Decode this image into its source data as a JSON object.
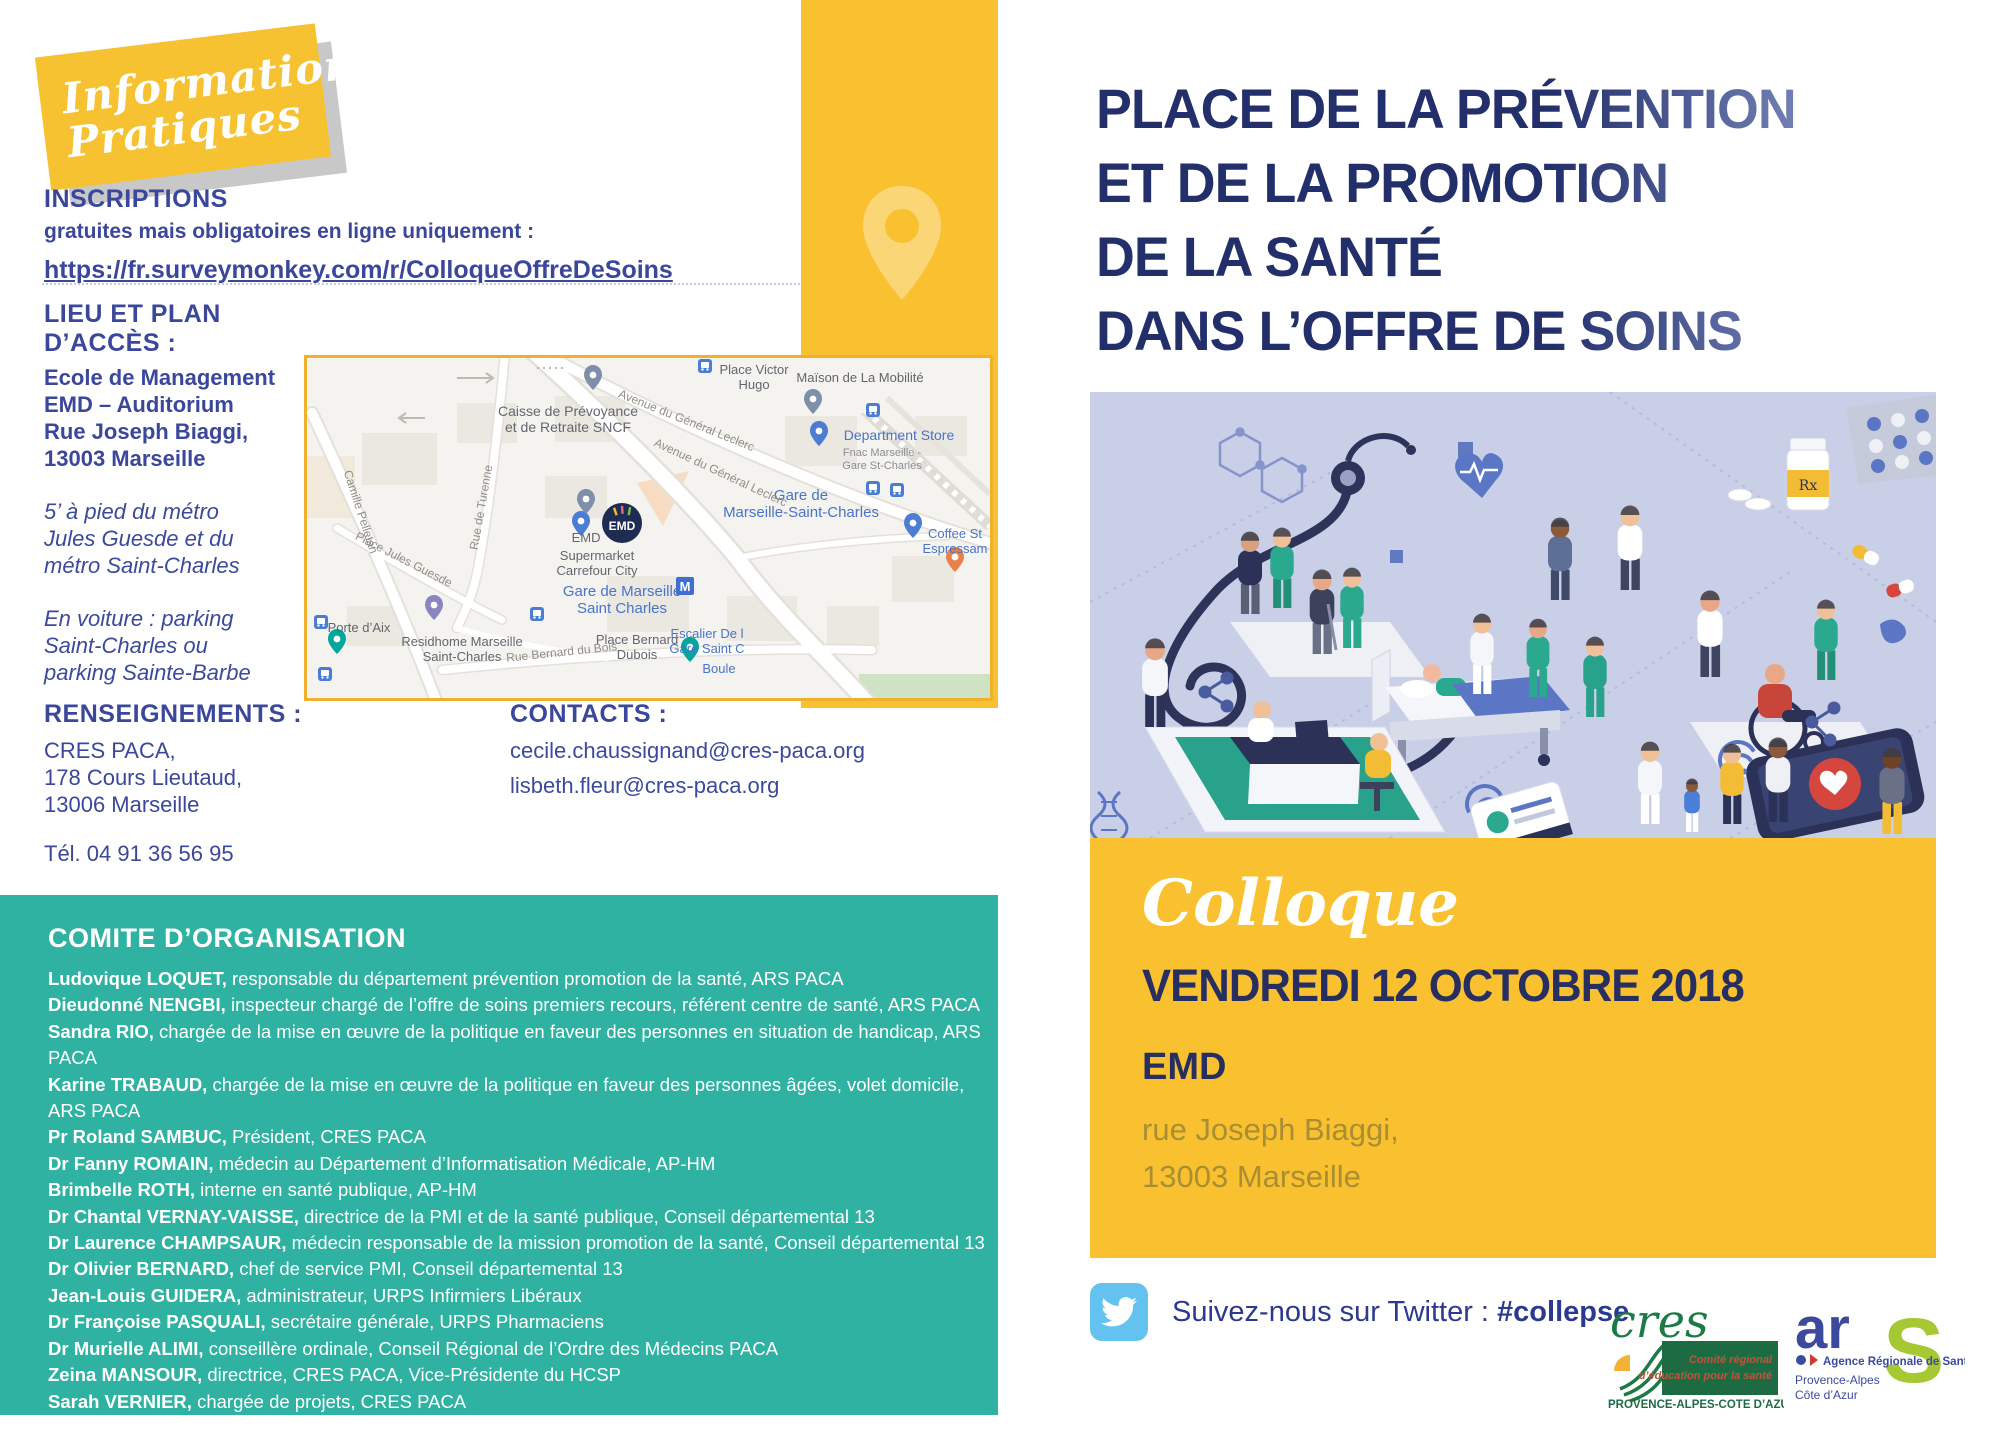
{
  "badge": {
    "line1": "Informations",
    "line2": "Pratiques"
  },
  "inscriptions": {
    "title": "INSCRIPTIONS",
    "subtitle": "gratuites mais obligatoires en ligne uniquement :",
    "link": "https://fr.surveymonkey.com/r/ColloqueOffreDeSoins"
  },
  "lieu": {
    "title": "LIEU ET PLAN D’ACCÈS :",
    "address_lines": [
      "Ecole de Management EMD – Auditorium",
      "Rue Joseph Biaggi,",
      "13003 Marseille"
    ],
    "metro": "5’ à pied du métro Jules Guesde et du métro Saint-Charles",
    "voiture": "En voiture : parking Saint-Charles ou parking Sainte-Barbe"
  },
  "renseignements": {
    "title": "RENSEIGNEMENTS :",
    "lines": [
      "CRES PACA,",
      "178 Cours Lieutaud,",
      "13006 Marseille"
    ],
    "tel": "Tél. 04 91 36 56 95",
    "site": "www.cres-paca.org"
  },
  "contacts": {
    "title": "CONTACTS :",
    "emails": [
      "cecile.chaussignand@cres-paca.org",
      "lisbeth.fleur@cres-paca.org"
    ]
  },
  "comite": {
    "title": "COMITE D’ORGANISATION",
    "members": [
      {
        "name": "Ludovique LOQUET",
        "role": "responsable du département prévention promotion de la santé, ARS PACA"
      },
      {
        "name": "Dieudonné NENGBI",
        "role": "inspecteur chargé de l’offre de soins premiers recours, référent centre de santé, ARS PACA"
      },
      {
        "name": "Sandra RIO",
        "role": "chargée de la mise en œuvre de la politique en faveur des personnes en situation de handicap, ARS PACA"
      },
      {
        "name": "Karine TRABAUD",
        "role": "chargée de la mise en œuvre de la politique en faveur des personnes âgées, volet domicile, ARS PACA"
      },
      {
        "name": "Pr Roland SAMBUC",
        "role": "Président, CRES PACA"
      },
      {
        "name": "Dr Fanny ROMAIN",
        "role": "médecin au Département d’Informatisation Médicale, AP-HM"
      },
      {
        "name": "Brimbelle ROTH",
        "role": "interne en santé publique, AP-HM"
      },
      {
        "name": "Dr Chantal VERNAY-VAISSE",
        "role": "directrice de la PMI et de la santé publique, Conseil départemental 13"
      },
      {
        "name": "Dr Laurence CHAMPSAUR",
        "role": "médecin responsable de la mission promotion de la santé, Conseil départemental 13"
      },
      {
        "name": "Dr Olivier BERNARD",
        "role": "chef de service PMI, Conseil départemental 13"
      },
      {
        "name": "Jean-Louis GUIDERA",
        "role": "administrateur, URPS Infirmiers Libéraux"
      },
      {
        "name": "Dr Françoise PASQUALI",
        "role": "secrétaire générale, URPS Pharmaciens"
      },
      {
        "name": "Dr Murielle ALIMI",
        "role": "conseillère ordinale, Conseil Régional de l’Ordre des Médecins PACA"
      },
      {
        "name": "Zeina MANSOUR",
        "role": "directrice, CRES PACA, Vice-Présidente du HCSP"
      },
      {
        "name": "Sarah VERNIER",
        "role": "chargée de projets, CRES PACA"
      },
      {
        "name": "Cécile CHAUSSIGNAND",
        "role": "chargée de projets, CRES PACA"
      }
    ]
  },
  "map": {
    "emd_logo": "EMD",
    "labels": [
      {
        "lines": [
          "Place Victor",
          "Hugo"
        ],
        "x": 447,
        "y": 16,
        "cls": "m-gray",
        "size": 13
      },
      {
        "lines": [
          "Maïson de La Mobilité"
        ],
        "x": 553,
        "y": 24,
        "cls": "m-gray",
        "size": 13
      },
      {
        "lines": [
          "Department Store"
        ],
        "x": 592,
        "y": 82,
        "cls": "m-blue",
        "size": 14
      },
      {
        "lines": [
          "Fnac Marseille -",
          "Gare St-Charles"
        ],
        "x": 575,
        "y": 98,
        "cls": "m-sub",
        "size": 11
      },
      {
        "lines": [
          "Gare de",
          "Marseille-Saint-Charles"
        ],
        "x": 494,
        "y": 142,
        "cls": "m-blue",
        "size": 15
      },
      {
        "lines": [
          "Coffee St",
          "Espressam"
        ],
        "x": 648,
        "y": 180,
        "cls": "m-blue",
        "size": 13
      },
      {
        "lines": [
          "Supermarket",
          "Carrefour City"
        ],
        "x": 290,
        "y": 202,
        "cls": "m-gray",
        "size": 13
      },
      {
        "lines": [
          "Gare de Marseille",
          "Saint Charles"
        ],
        "x": 315,
        "y": 238,
        "cls": "m-blue",
        "size": 15
      },
      {
        "lines": [
          "Place Bernard",
          "Dubois"
        ],
        "x": 330,
        "y": 286,
        "cls": "m-gray",
        "size": 13
      },
      {
        "lines": [
          "Escalier De l",
          "Gare Saint C"
        ],
        "x": 400,
        "y": 280,
        "cls": "m-blue",
        "size": 13
      },
      {
        "lines": [
          "Boule"
        ],
        "x": 412,
        "y": 315,
        "cls": "m-blue",
        "size": 13
      },
      {
        "lines": [
          "Residhome Marseille",
          "Saint-Charles"
        ],
        "x": 155,
        "y": 288,
        "cls": "m-gray",
        "size": 13
      },
      {
        "lines": [
          "Rue Bernard du Bois"
        ],
        "x": 255,
        "y": 298,
        "cls": "m-street",
        "size": 12,
        "rotate": -6
      },
      {
        "lines": [
          "Porte d’Aix"
        ],
        "x": 52,
        "y": 274,
        "cls": "m-gray",
        "size": 13
      },
      {
        "lines": [
          "Place Jules Guesde"
        ],
        "x": 95,
        "y": 205,
        "cls": "m-street",
        "size": 12,
        "rotate": 27
      },
      {
        "lines": [
          "Rue de Turenne"
        ],
        "x": 178,
        "y": 150,
        "cls": "m-street",
        "size": 12,
        "rotate": -80
      },
      {
        "lines": [
          "Camille Pelletan"
        ],
        "x": 50,
        "y": 155,
        "cls": "m-street",
        "size": 12,
        "rotate": 72
      },
      {
        "lines": [
          "Caisse de Prévoyance",
          "et de Retraite SNCF"
        ],
        "x": 261,
        "y": 58,
        "cls": "m-gray",
        "size": 14
      },
      {
        "lines": [
          "Avenue du Général Leclerc"
        ],
        "x": 378,
        "y": 66,
        "cls": "m-street",
        "size": 12,
        "rotate": 22
      },
      {
        "lines": [
          "Avenue du Général Leclerc"
        ],
        "x": 412,
        "y": 118,
        "cls": "m-street",
        "size": 12,
        "rotate": 25
      },
      {
        "lines": [
          "EMD"
        ],
        "x": 279,
        "y": 184,
        "cls": "m-gray",
        "size": 13
      }
    ],
    "markers": [
      {
        "type": "transit",
        "x": 398,
        "y": 8
      },
      {
        "type": "pin",
        "x": 506,
        "y": 56,
        "color": "#7e8fa9"
      },
      {
        "type": "transit",
        "x": 566,
        "y": 52
      },
      {
        "type": "pin",
        "x": 512,
        "y": 88,
        "color": "#4a7dd3"
      },
      {
        "type": "transit",
        "x": 566,
        "y": 130
      },
      {
        "type": "transit",
        "x": 590,
        "y": 132
      },
      {
        "type": "pin",
        "x": 606,
        "y": 180,
        "color": "#4a7dd3"
      },
      {
        "type": "pin",
        "x": 648,
        "y": 214,
        "color": "#e8824b"
      },
      {
        "type": "pin",
        "x": 274,
        "y": 178,
        "color": "#4a7dd3"
      },
      {
        "type": "metro",
        "x": 378,
        "y": 228
      },
      {
        "type": "pin",
        "x": 127,
        "y": 262,
        "color": "#8a84c0"
      },
      {
        "type": "pin",
        "x": 30,
        "y": 296,
        "color": "#00a79d"
      },
      {
        "type": "transit",
        "x": 14,
        "y": 264
      },
      {
        "type": "transit",
        "x": 18,
        "y": 316
      },
      {
        "type": "transit",
        "x": 230,
        "y": 256
      },
      {
        "type": "pin",
        "x": 383,
        "y": 304,
        "color": "#00a79d"
      },
      {
        "type": "pin",
        "x": 286,
        "y": 32,
        "color": "#7e8fa9"
      },
      {
        "type": "pin",
        "x": 279,
        "y": 156,
        "color": "#7e8fa9"
      },
      {
        "type": "emd",
        "x": 315,
        "y": 165
      }
    ]
  },
  "right": {
    "title_lines": [
      "PLACE DE LA PRÉVENTION",
      "ET DE LA PROMOTION",
      "DE LA SANTÉ",
      "DANS L’OFFRE DE SOINS"
    ],
    "event": {
      "type": "Colloque",
      "date": "VENDREDI 12 OCTOBRE 2018",
      "place": "EMD",
      "address1": "rue Joseph Biaggi,",
      "address2": "13003 Marseille"
    },
    "twitter": {
      "prefix": "Suivez-nous sur Twitter : ",
      "hashtag": "#collepse"
    }
  },
  "logos": {
    "cres": {
      "name": "cres",
      "sub1": "Comité régional",
      "sub2": "d’éducation pour la santé",
      "region": "PROVENCE-ALPES-COTE D’AZUR"
    },
    "ars": {
      "ar": "ar",
      "s": "S",
      "line": "Agence Régionale de Santé",
      "region1": "Provence-Alpes",
      "region2": "Côte d’Azur"
    }
  },
  "colors": {
    "yellow": "#f9c130",
    "teal": "#2fb2a1",
    "navy": "#222f6b",
    "blue_text": "#3a479a",
    "twitter_blue": "#63c2f0",
    "illustration_bg": "#c9cfe7"
  }
}
